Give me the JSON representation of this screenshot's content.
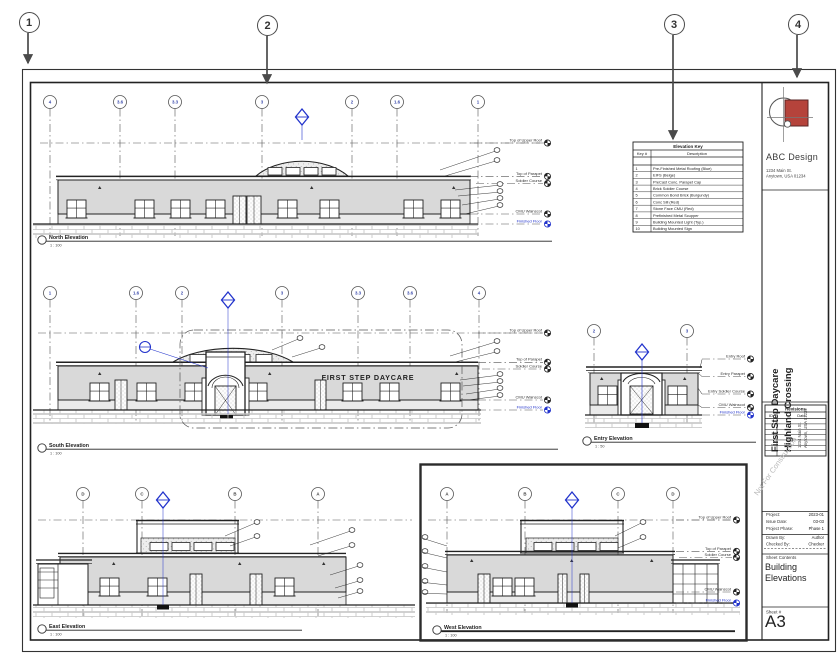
{
  "annotations": {
    "callouts": [
      "1",
      "2",
      "3",
      "4"
    ]
  },
  "sheet": {
    "sign_text": "FIRST STEP DAYCARE",
    "elevation_key": {
      "title": "Elevation Key",
      "columns": [
        "Key #",
        "Description"
      ],
      "rows": [
        [
          "1",
          "Pre-Finished Metal Roofing (Blue)"
        ],
        [
          "2",
          "EIFS (Beige)"
        ],
        [
          "3",
          "PreCast Conc. Parapet Cap"
        ],
        [
          "4",
          "Brick Soldier Course"
        ],
        [
          "5",
          "Common Bond Brick (Burgundy)"
        ],
        [
          "6",
          "Conc Sill (Red)"
        ],
        [
          "7",
          "Stone Face CMU (Red)"
        ],
        [
          "8",
          "Prefinished Metal Scupper"
        ],
        [
          "9",
          "Building Mounted Light (Typ.)"
        ],
        [
          "10",
          "Building Mounted Sign"
        ]
      ]
    },
    "elevations": [
      {
        "name": "North Elevation",
        "scale": "1 : 100",
        "grids": [
          "4",
          "3.6",
          "3.3",
          "3",
          "2",
          "1.6",
          "1"
        ],
        "levels": [
          "Top of Upper Roof",
          "Top of Parapet",
          "Soldier Course",
          "CMU Wainscot",
          "Finished Floor"
        ]
      },
      {
        "name": "South Elevation",
        "scale": "1 : 100",
        "grids": [
          "1",
          "1.6",
          "2",
          "3",
          "3.3",
          "3.6",
          "4"
        ],
        "levels": [
          "Top of Upper Roof",
          "Top of Parapet",
          "Soldier Course",
          "CMU Wainscot",
          "Finished Floor"
        ]
      },
      {
        "name": "Entry Elevation",
        "scale": "1 : 50",
        "grids": [
          "2",
          "3"
        ],
        "levels": [
          "Entry Roof",
          "Entry Parapet",
          "Entry Soldier Course",
          "CMU Wainscot",
          "Finished Floor"
        ]
      },
      {
        "name": "East Elevation",
        "scale": "1 : 100",
        "grids": [
          "D",
          "C",
          "B",
          "A"
        ],
        "levels": []
      },
      {
        "name": "West Elevation",
        "scale": "1 : 100",
        "grids": [
          "A",
          "B",
          "C",
          "D"
        ],
        "levels": [
          "Top of Upper Roof",
          "Top of Parapet",
          "Soldier Course",
          "CMU Wainscot",
          "Finished Floor"
        ]
      }
    ]
  },
  "title_block": {
    "firm": "ABC Design",
    "firm_address": [
      "1234 Main St.",
      "Anytown, USA 01234"
    ],
    "project_name": "First Step Daycare",
    "project_name2": "Highland Crossing",
    "project_address": [
      "1234 Main St.",
      "Anytown, USA 01234"
    ],
    "revisions": {
      "title": "Revisions",
      "columns": [
        "ID",
        "Date"
      ]
    },
    "watermark": "Not For Construction",
    "fields": [
      [
        "Project:",
        "2023-01"
      ],
      [
        "Issue Date:",
        "03-03"
      ],
      [
        "Project Phase:",
        "Phase 1"
      ],
      [
        "Drawn By:",
        "Author"
      ],
      [
        "Checked By:",
        "Checker"
      ]
    ],
    "sheet_contents_label": "Sheet Contents",
    "sheet_contents": "Building Elevations",
    "sheet_number_label": "Sheet #",
    "sheet_number": "A3",
    "colors": {
      "logo_red": "#b5433b",
      "marker_blue": "#2233cc",
      "grid_blue": "#3949ab"
    }
  }
}
